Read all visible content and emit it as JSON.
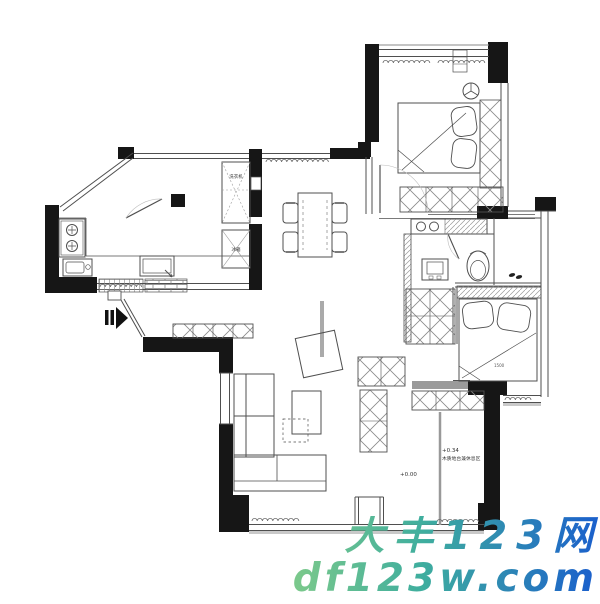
{
  "floor_plan": {
    "labels": {
      "washing_machine": "洗衣机",
      "fridge": "冰箱",
      "platform_elevation": "+0.34",
      "platform_note": "木质地台兼休息区",
      "floor_elevation": "+0.00",
      "bed_width": "1500"
    },
    "colors": {
      "wall": "#161616",
      "line": "#4f4f4f",
      "light_line": "#8a8a8a",
      "sill": "#c9c9c9"
    }
  },
  "watermark": {
    "line1": "大丰123网",
    "line2": "df123w.com",
    "gradient_start": "#7cc98b",
    "gradient_mid": "#3fae9e",
    "gradient_end": "#1a5ecd"
  }
}
